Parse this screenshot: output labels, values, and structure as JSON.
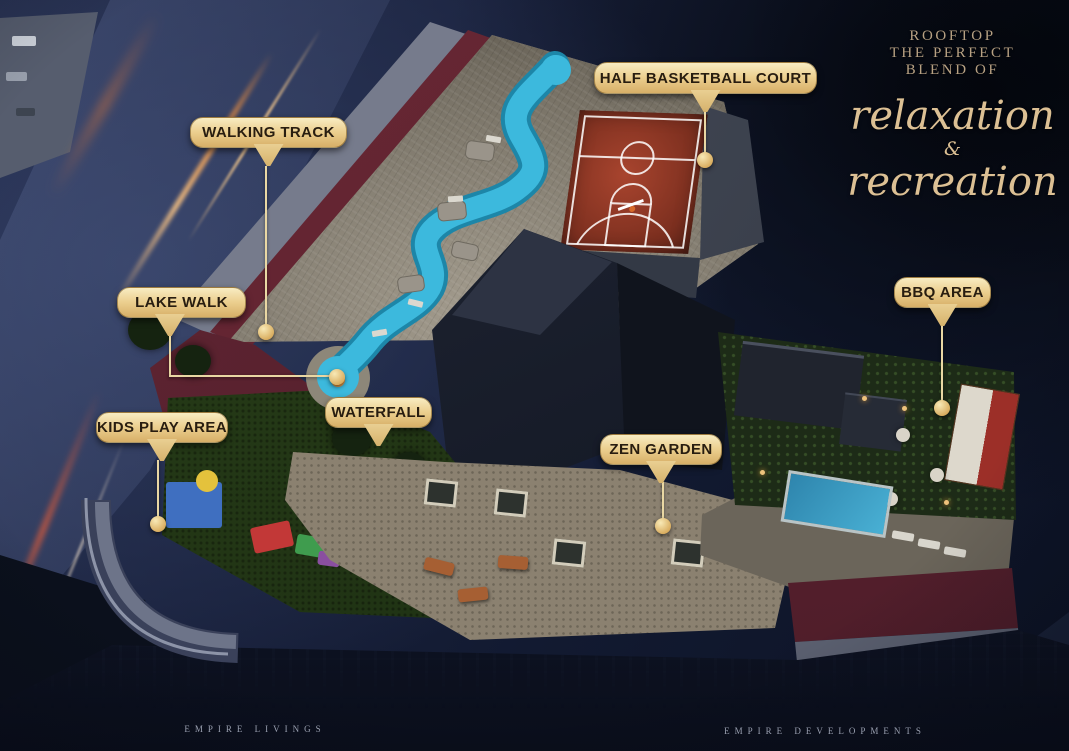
{
  "headline": {
    "kicker_lines": [
      "ROOFTOP",
      "THE PERFECT",
      "BLEND OF"
    ],
    "script_line1": "relaxation",
    "ampersand": "&",
    "script_line2": "recreation"
  },
  "callouts": [
    {
      "id": "walking-track",
      "label": "WALKING TRACK"
    },
    {
      "id": "half-basketball-court",
      "label": "HALF BASKETBALL COURT"
    },
    {
      "id": "lake-walk",
      "label": "LAKE WALK"
    },
    {
      "id": "kids-play-area",
      "label": "KIDS PLAY AREA"
    },
    {
      "id": "waterfall",
      "label": "WATERFALL"
    },
    {
      "id": "zen-garden",
      "label": "ZEN GARDEN"
    },
    {
      "id": "bbq-area",
      "label": "BBQ AREA"
    }
  ],
  "footer": {
    "brand_left": "EMPIRE LIVINGS",
    "brand_right": "EMPIRE DEVELOPMENTS"
  },
  "colors": {
    "label_gold": "#eccf8f",
    "label_text": "#281d10",
    "headline_serif_gold": "#b7a183",
    "headline_script_gold": "#dcc094",
    "leader_line": "#e9d7a3",
    "night_navy": "#121a31",
    "river_blue": "#3cb9dd",
    "court_red": "#8f3a27",
    "track_maroon": "#5d2330",
    "lawn_green": "#2c421c",
    "paving_stone": "#8a8477",
    "light_trail_orange": "#e08a42"
  }
}
